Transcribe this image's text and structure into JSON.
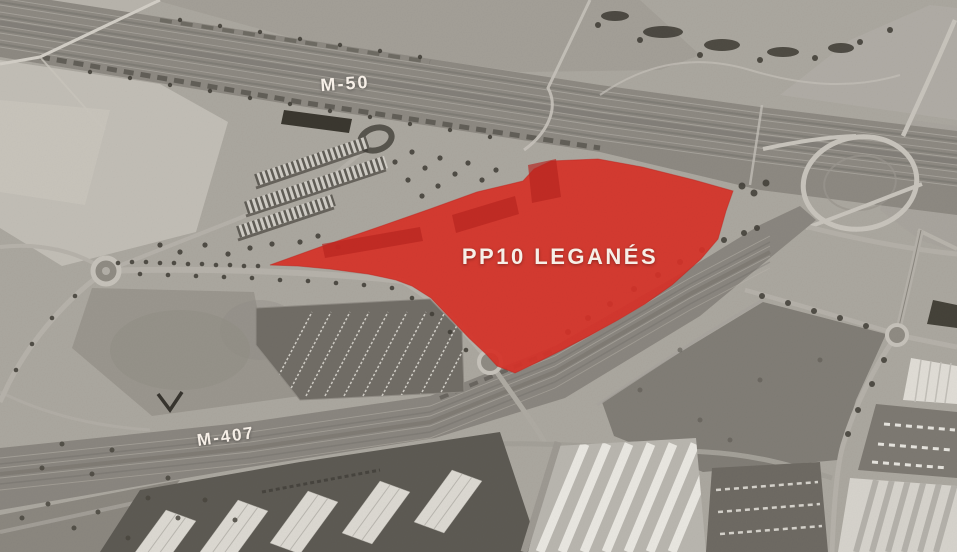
{
  "map": {
    "labels": {
      "m50": "M-50",
      "m407": "M-407",
      "zone": "PP10 LEGANÉS"
    },
    "colors": {
      "highlight": "#d73128",
      "label_text": "#f6efe7"
    }
  }
}
